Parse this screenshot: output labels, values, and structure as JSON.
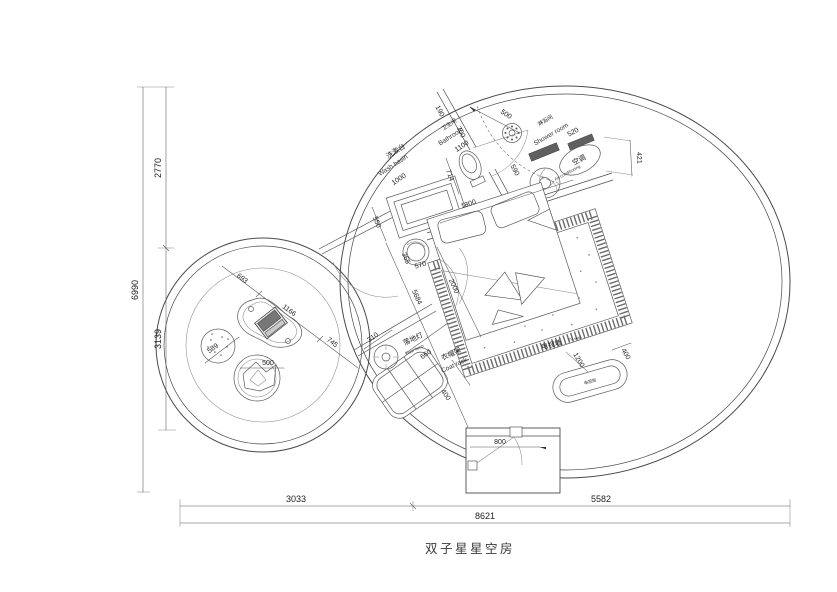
{
  "title": "双子星星空房",
  "colors": {
    "line": "#4a4a4a",
    "dark_fill": "#5f5f5f",
    "background": "#ffffff"
  },
  "overall_dims": {
    "left_total": "6990",
    "left_upper": "2770",
    "left_lower": "3139",
    "bottom_left": "3033",
    "bottom_right": "5582",
    "bottom_total": "8621"
  },
  "bathroom_zone": {
    "wash_basin_cn": "洗漱台",
    "wash_basin_en": "Wash basin",
    "wash_basin_width": "1000",
    "bathroom_cn": "卫生间",
    "bathroom_en": "Bathroom",
    "bathroom_width": "1100",
    "shower_cn": "淋浴间",
    "shower_en": "Shower room",
    "d190": "190",
    "d700": "700",
    "d500": "500",
    "d590": "590",
    "d550": "550",
    "d714": "714",
    "d365": "365",
    "d570": "570"
  },
  "ac_zone": {
    "ac_cn": "空调",
    "ac_en": "Air-conditioning",
    "d520": "520",
    "d421": "421"
  },
  "bedroom_zone": {
    "bed_width": "1800",
    "bed_length": "2000",
    "d5684": "5684"
  },
  "tv_zone": {
    "tv_wall_cn": "电视墙",
    "tv_wall_en": "TV wall",
    "cabinet_cn": "电视柜",
    "length": "1200",
    "depth": "400"
  },
  "entry_zone": {
    "door_width": "800"
  },
  "accessories": {
    "floor_lamp_cn": "落地灯",
    "floor_lamp_en": "Floor lamp",
    "floor_lamp_d": "310",
    "coat_rack_cn": "衣帽架",
    "coat_rack_en": "Coat rack",
    "coat_rack_w": "660",
    "coat_rack_d": "400"
  },
  "lounge_zone": {
    "d693": "693",
    "d1166": "1166",
    "d745": "745",
    "stool_d": "589",
    "chair_d": "500"
  }
}
